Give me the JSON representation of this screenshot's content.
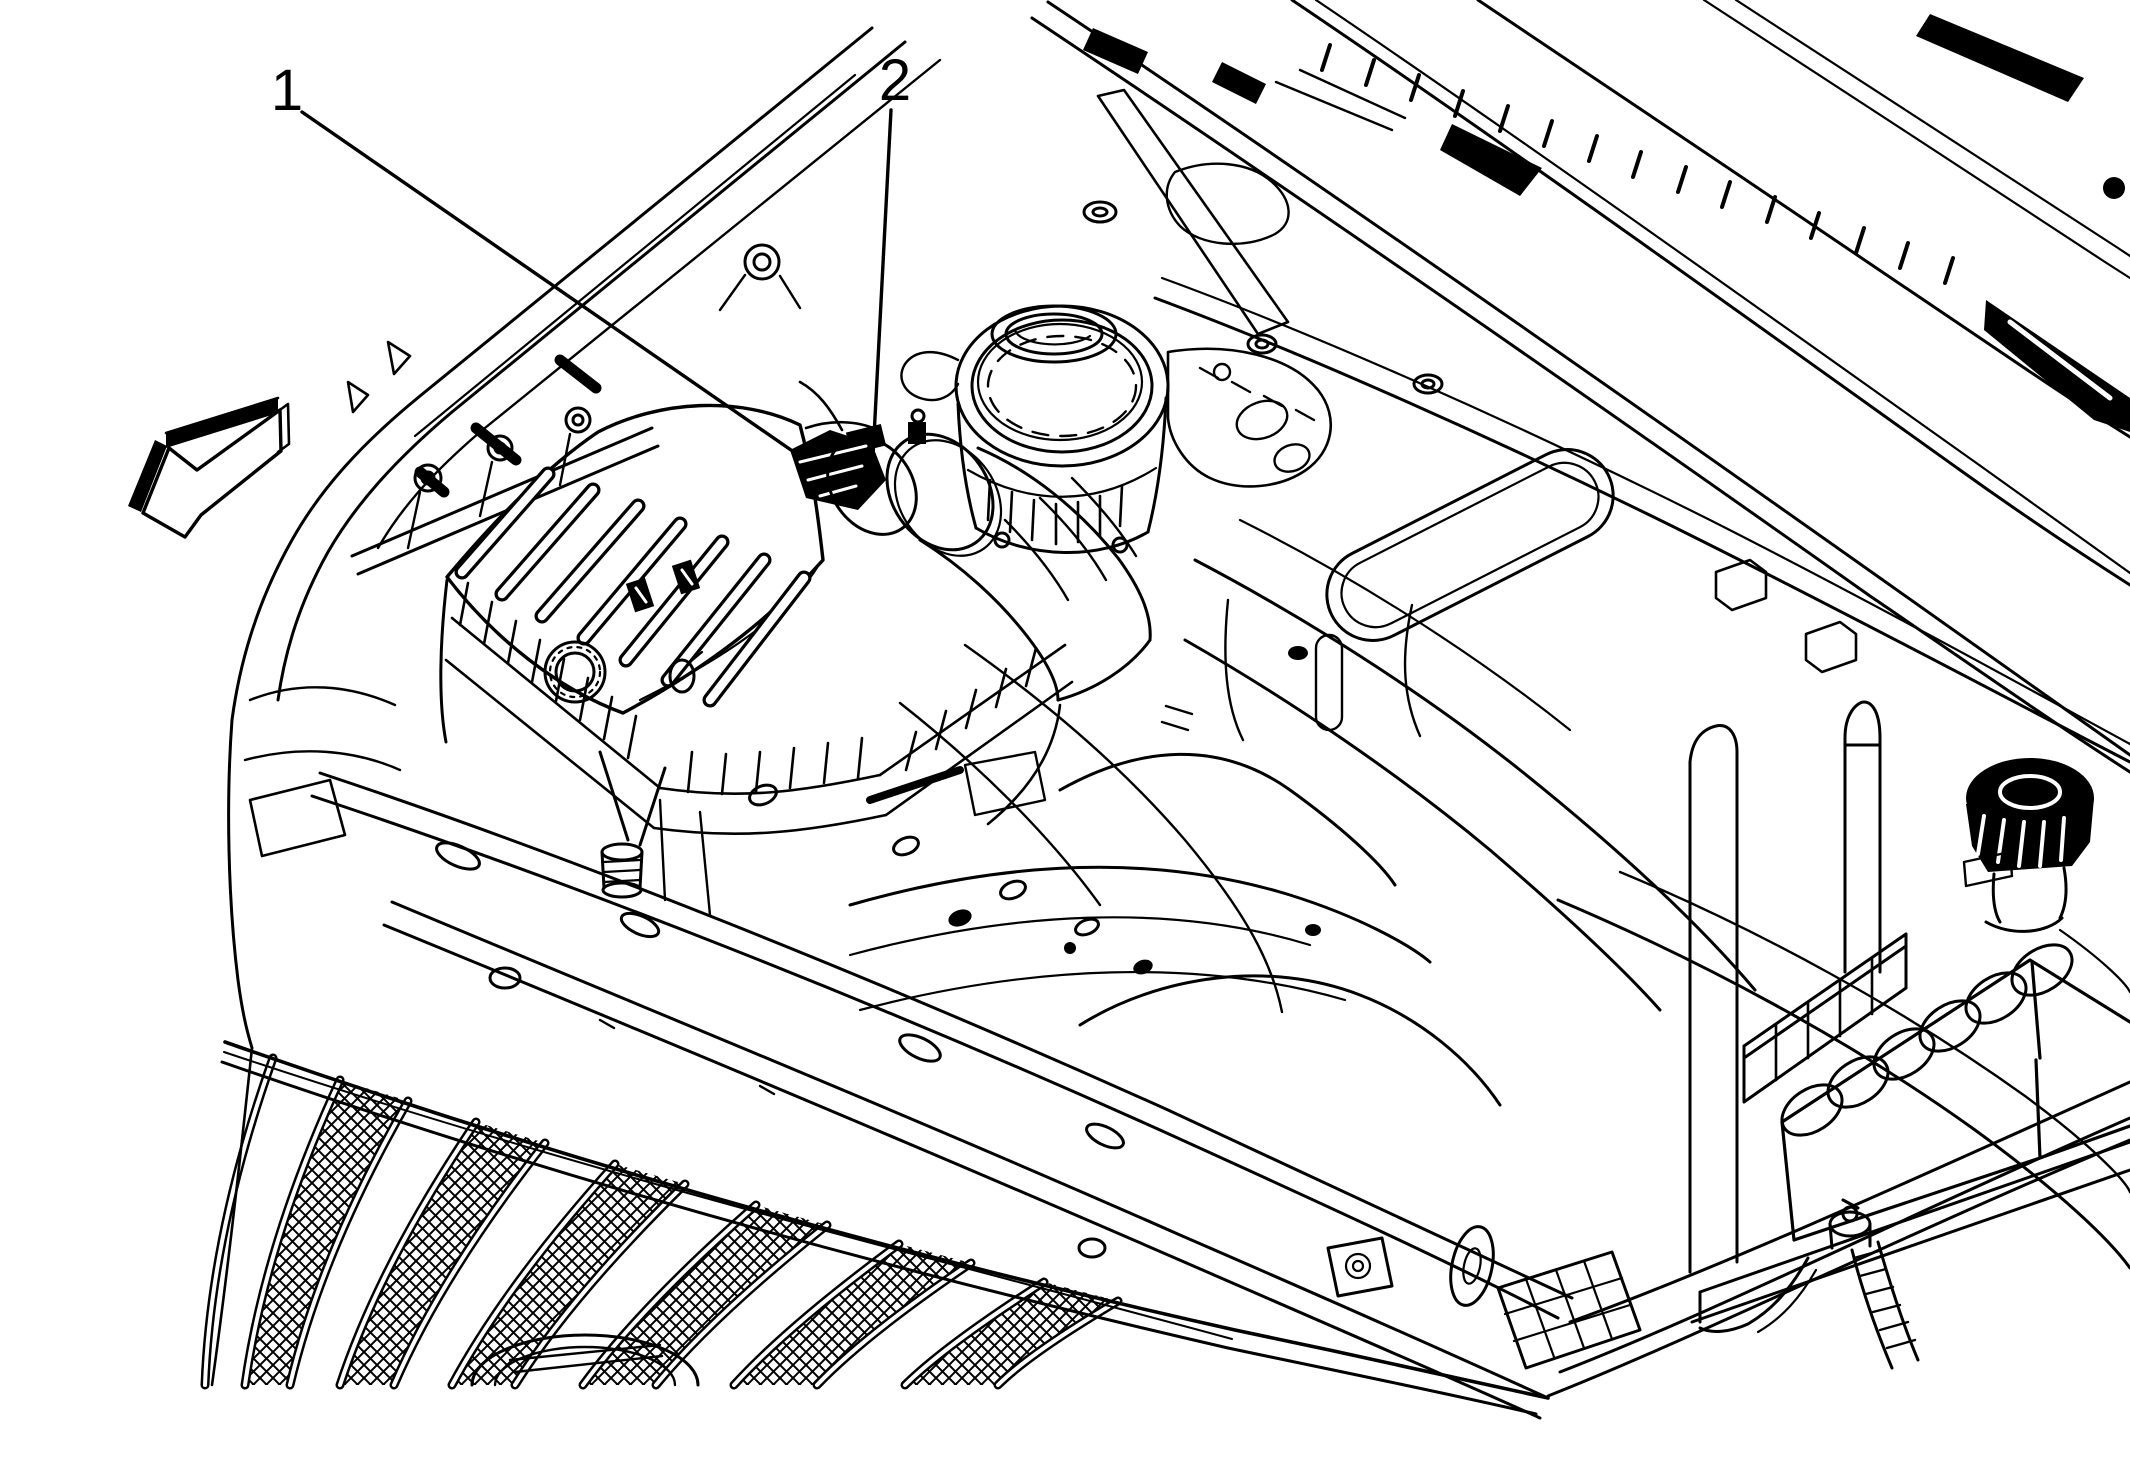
{
  "figure": {
    "kind": "service-manual-line-illustration",
    "subject": "engine-compartment-front-corner-view",
    "background_color": "#ffffff",
    "line_color": "#000000"
  },
  "callouts": [
    {
      "label": "1"
    },
    {
      "label": "2"
    }
  ],
  "icons": {
    "view_direction_arrow": "block-arrow-pointing-lower-left"
  }
}
